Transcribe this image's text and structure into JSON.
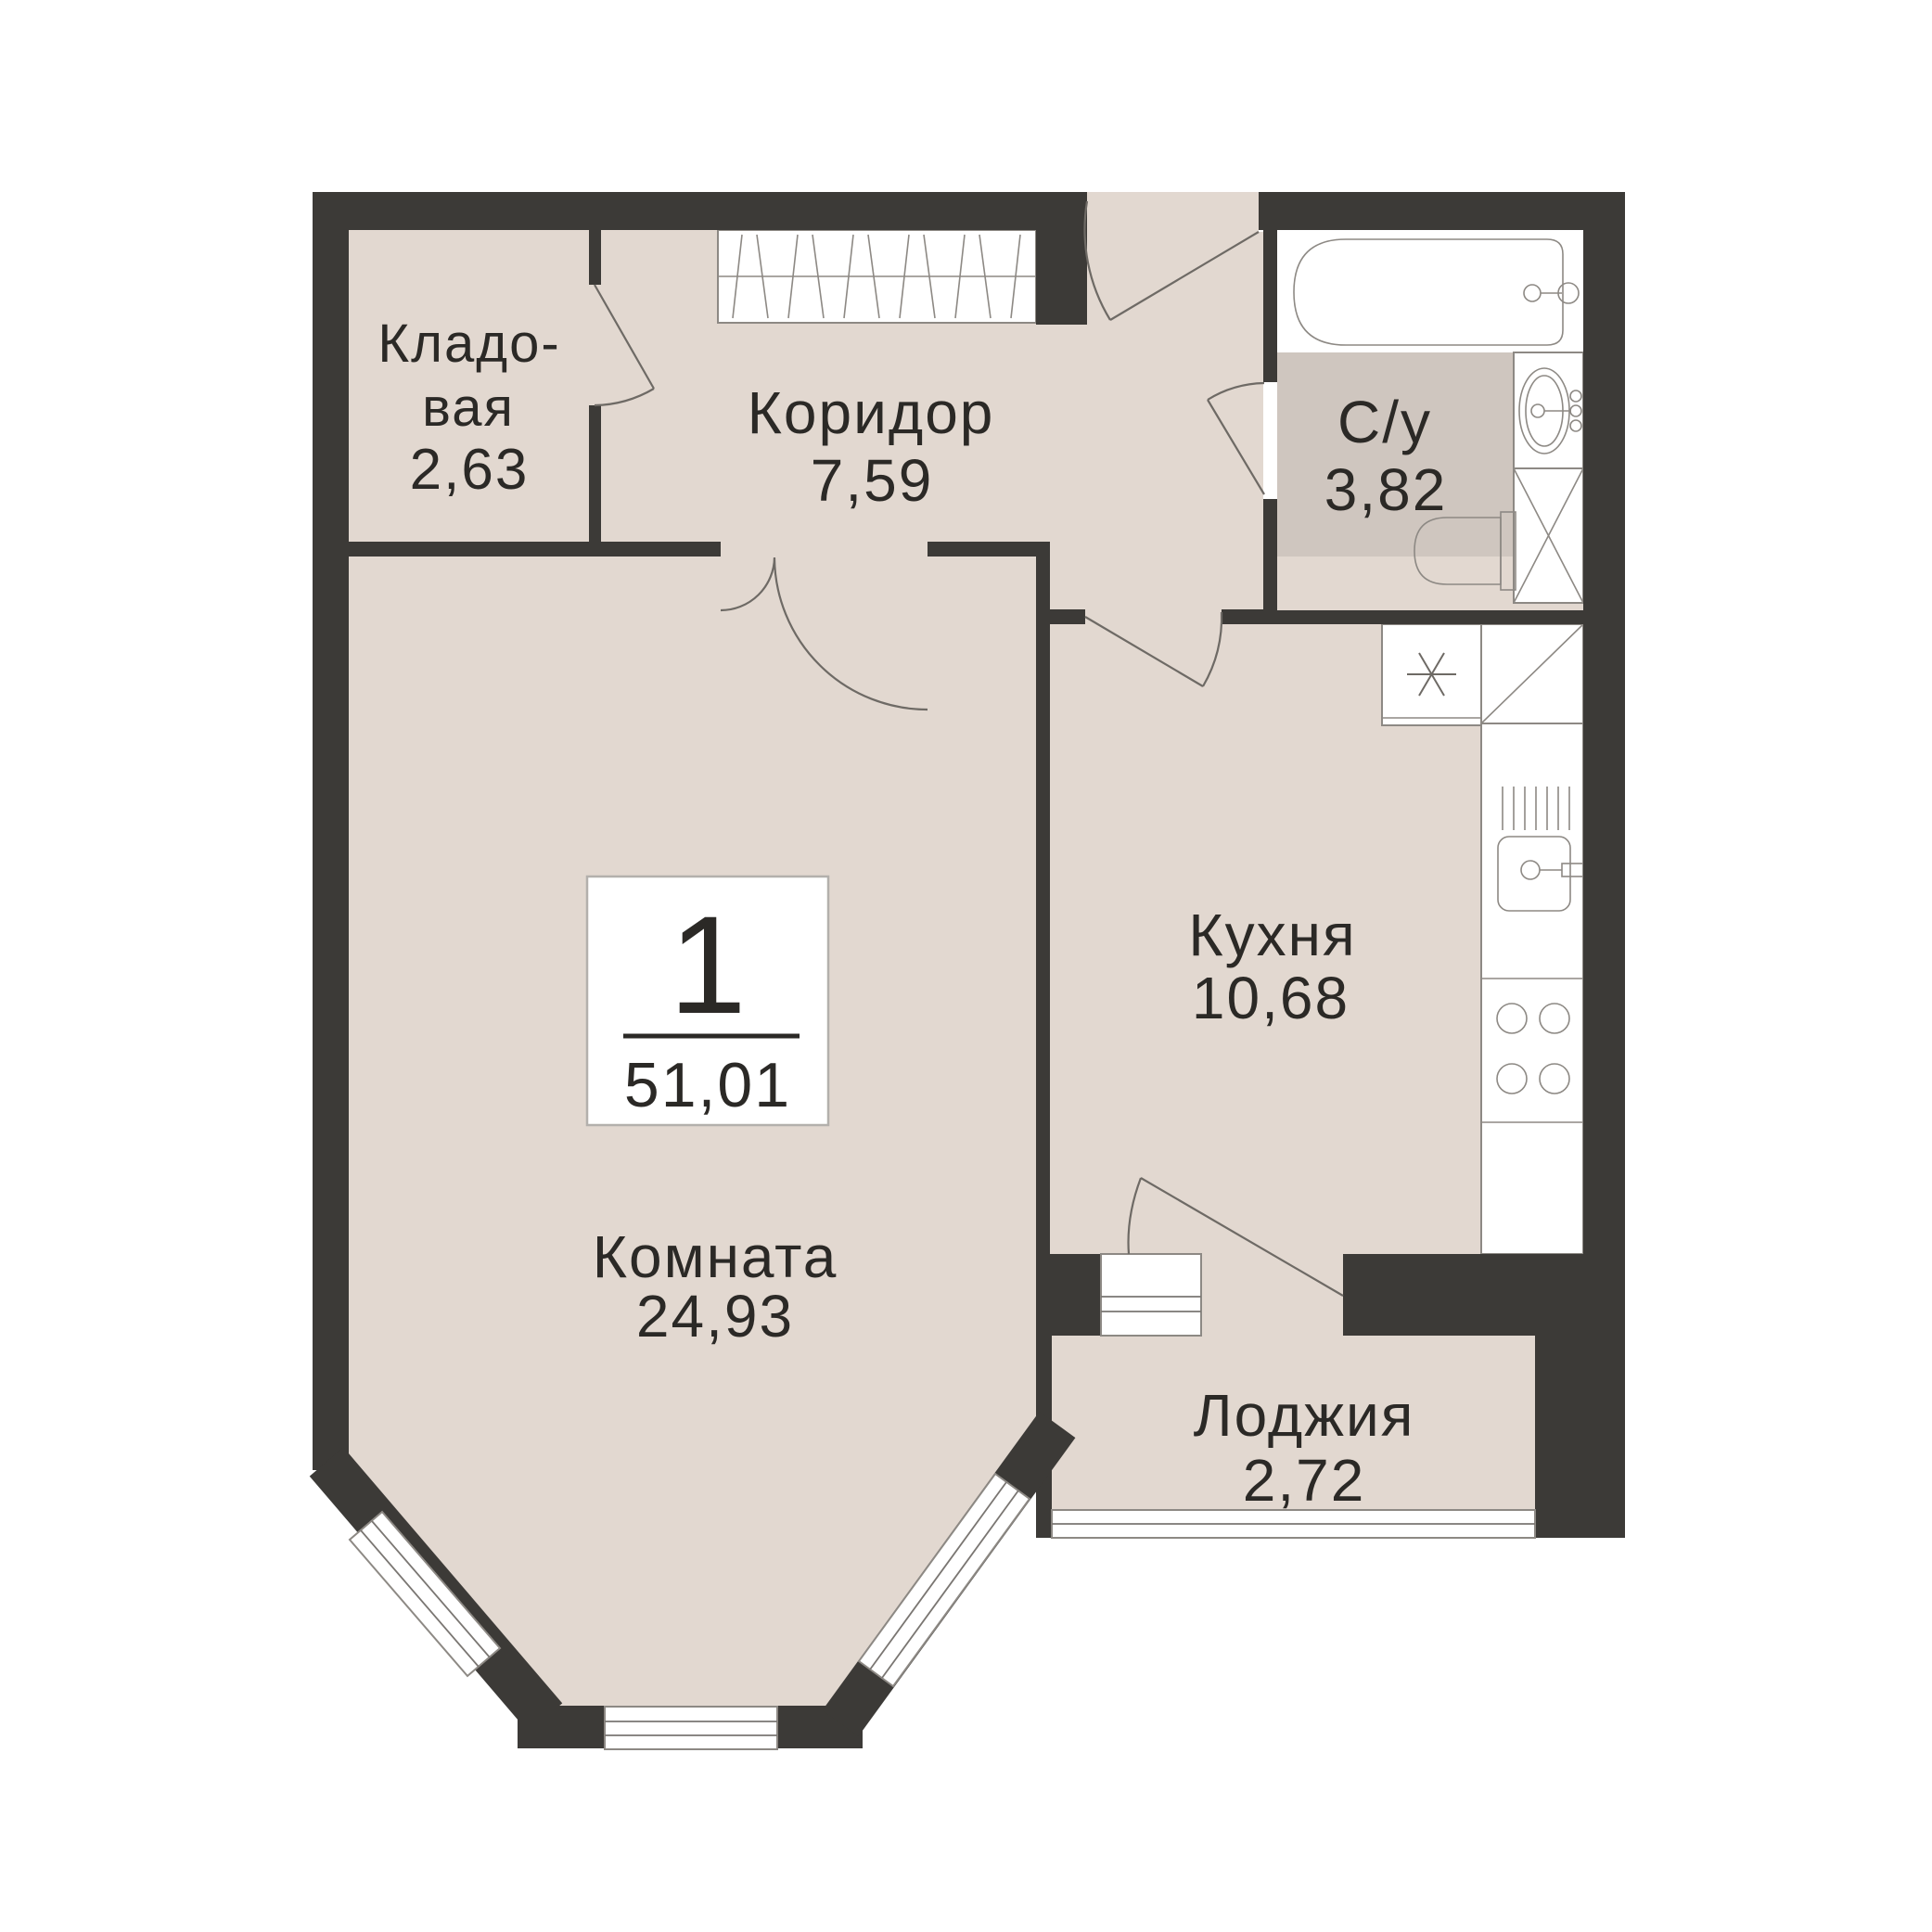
{
  "plan": {
    "type": "apartment-floor-plan",
    "unit": {
      "rooms_count": "1",
      "total_area": "51,01"
    },
    "rooms": {
      "storage": {
        "name_line1": "Кладо-",
        "name_line2": "вая",
        "area": "2,63"
      },
      "corridor": {
        "name": "Коридор",
        "area": "7,59"
      },
      "bathroom": {
        "name": "С/у",
        "area": "3,82"
      },
      "kitchen": {
        "name": "Кухня",
        "area": "10,68"
      },
      "room": {
        "name": "Комната",
        "area": "24,93"
      },
      "loggia": {
        "name": "Лоджия",
        "area": "2,72"
      }
    },
    "colors": {
      "background": "#ffffff",
      "wall": "#3c3a37",
      "floor": "#e2d8d0",
      "wet_floor": "#cfc6bf",
      "text": "#2b2926",
      "fixture_line": "#6e6a65"
    }
  }
}
